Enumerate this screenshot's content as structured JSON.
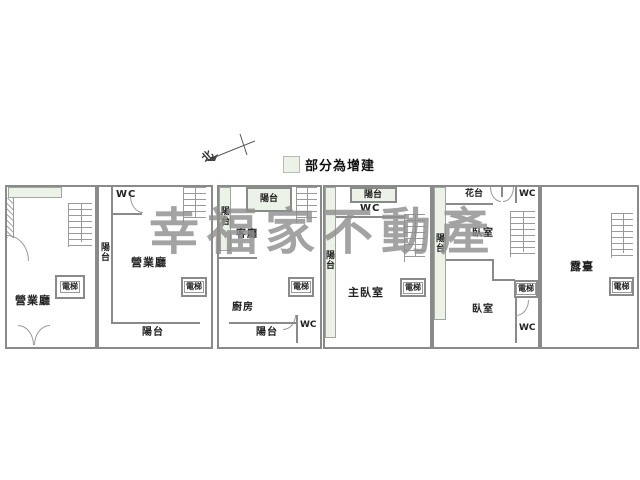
{
  "watermark": {
    "text": "幸福家不動產"
  },
  "legend": {
    "label": "部分為增建",
    "swatch_color": "#edf2e8"
  },
  "compass": {
    "north": "北"
  },
  "colors": {
    "wall": "#8a8a8a",
    "addition_fill": "#edf2e8",
    "watermark": "#8f8f8f"
  },
  "units": [
    {
      "rooms": {
        "main": "營業廳",
        "elevator": "電梯"
      }
    },
    {
      "rooms": {
        "wc": "WC",
        "balcony_left": "陽台",
        "main": "營業廳",
        "elevator": "電梯",
        "balcony_bottom": "陽台"
      }
    },
    {
      "rooms": {
        "balcony_left": "陽台",
        "balcony_top": "陽台",
        "living": "客廳",
        "kitchen": "廚房",
        "elevator": "電梯",
        "wc": "WC",
        "balcony_bottom": "陽台"
      }
    },
    {
      "rooms": {
        "balcony_left": "陽台",
        "balcony_top": "陽台",
        "wc": "WC",
        "master": "主臥室",
        "elevator": "電梯"
      }
    },
    {
      "rooms": {
        "balcony_left": "陽台",
        "flower_bed": "花台",
        "wc_top": "WC",
        "bedroom_upper": "臥室",
        "elevator": "電梯",
        "bedroom_lower": "臥室",
        "wc_bottom": "WC"
      }
    },
    {
      "rooms": {
        "terrace": "露臺",
        "elevator": "電梯"
      }
    }
  ]
}
